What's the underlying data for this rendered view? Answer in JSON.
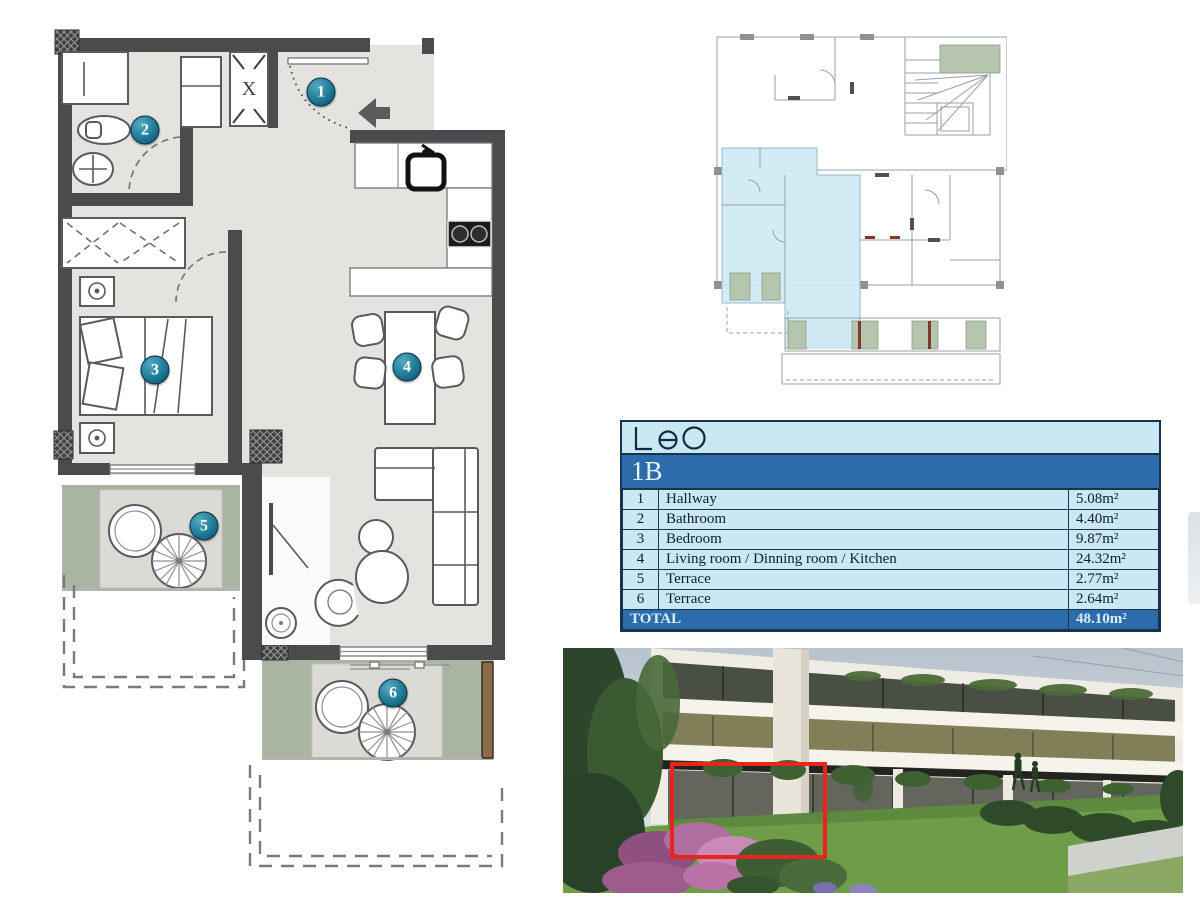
{
  "logo": {
    "text": "Leo"
  },
  "unit": {
    "id": "1B",
    "total_label": "TOTAL",
    "total_area": "48.10m²"
  },
  "rooms": [
    {
      "num": "1",
      "name": "Hallway",
      "area": "5.08m²"
    },
    {
      "num": "2",
      "name": "Bathroom",
      "area": "4.40m²"
    },
    {
      "num": "3",
      "name": "Bedroom",
      "area": "9.87m²"
    },
    {
      "num": "4",
      "name": "Living room / Dinning room / Kitchen",
      "area": "24.32m²"
    },
    {
      "num": "5",
      "name": "Terrace",
      "area": "2.77m²"
    },
    {
      "num": "6",
      "name": "Terrace",
      "area": "2.64m²"
    }
  ],
  "plan": {
    "closet_mark": "X"
  },
  "colors": {
    "wall_gray": "#4a4b4d",
    "floor_gray": "#e4e3e0",
    "terrace_green": "#a9b4a2",
    "badge_teal": "#1d7a96",
    "table_light_blue": "#c9e8f4",
    "table_dark_blue": "#2d6cab",
    "table_border": "#16344e",
    "highlight_blue": "#cfe9f3",
    "overview_green": "#b5c5ae",
    "marker_red": "#e8251d"
  }
}
